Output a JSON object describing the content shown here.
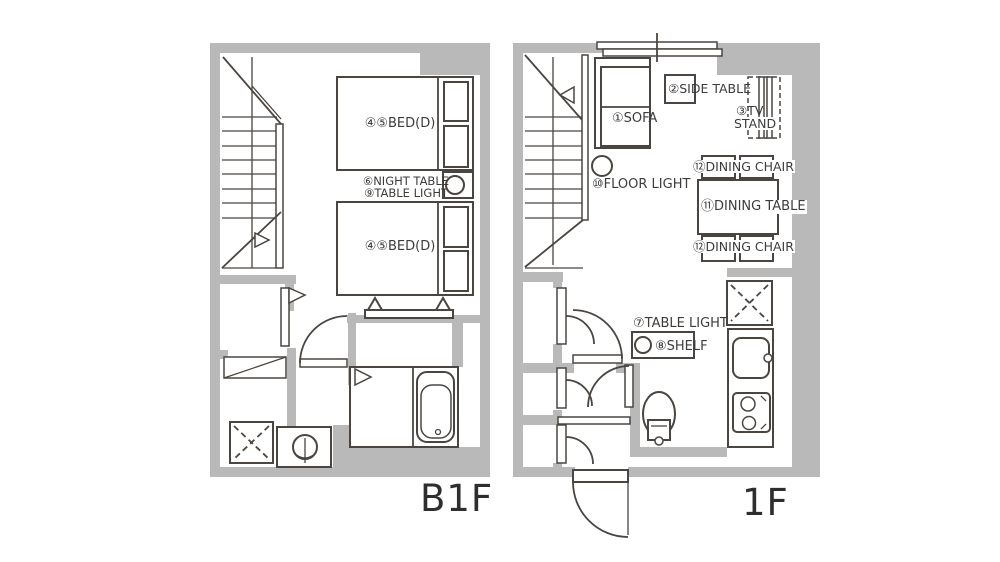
{
  "colors": {
    "wall": "#b9b9b9",
    "line": "#4a4540",
    "text": "#3c3c3c"
  },
  "b1f": {
    "title": "B1F",
    "bed1_label": "④⑤BED(D)",
    "bed2_label": "④⑤BED(D)",
    "night_table_label": "⑥NIGHT TABLE",
    "table_light_label": "⑨TABLE LIGHT"
  },
  "f1": {
    "title": "1F",
    "sofa_label": "①SOFA",
    "side_table_label": "②SIDE TABLE",
    "tv_stand_label_line1": "③TV",
    "tv_stand_label_line2": "STAND",
    "floor_light_label": "⑩FLOOR LIGHT",
    "dining_chair_top_label": "⑫DINING CHAIR",
    "dining_table_label": "⑪DINING TABLE",
    "dining_chair_bottom_label": "⑫DINING CHAIR",
    "table_light_label": "⑦TABLE LIGHT",
    "shelf_label": "⑧SHELF"
  }
}
